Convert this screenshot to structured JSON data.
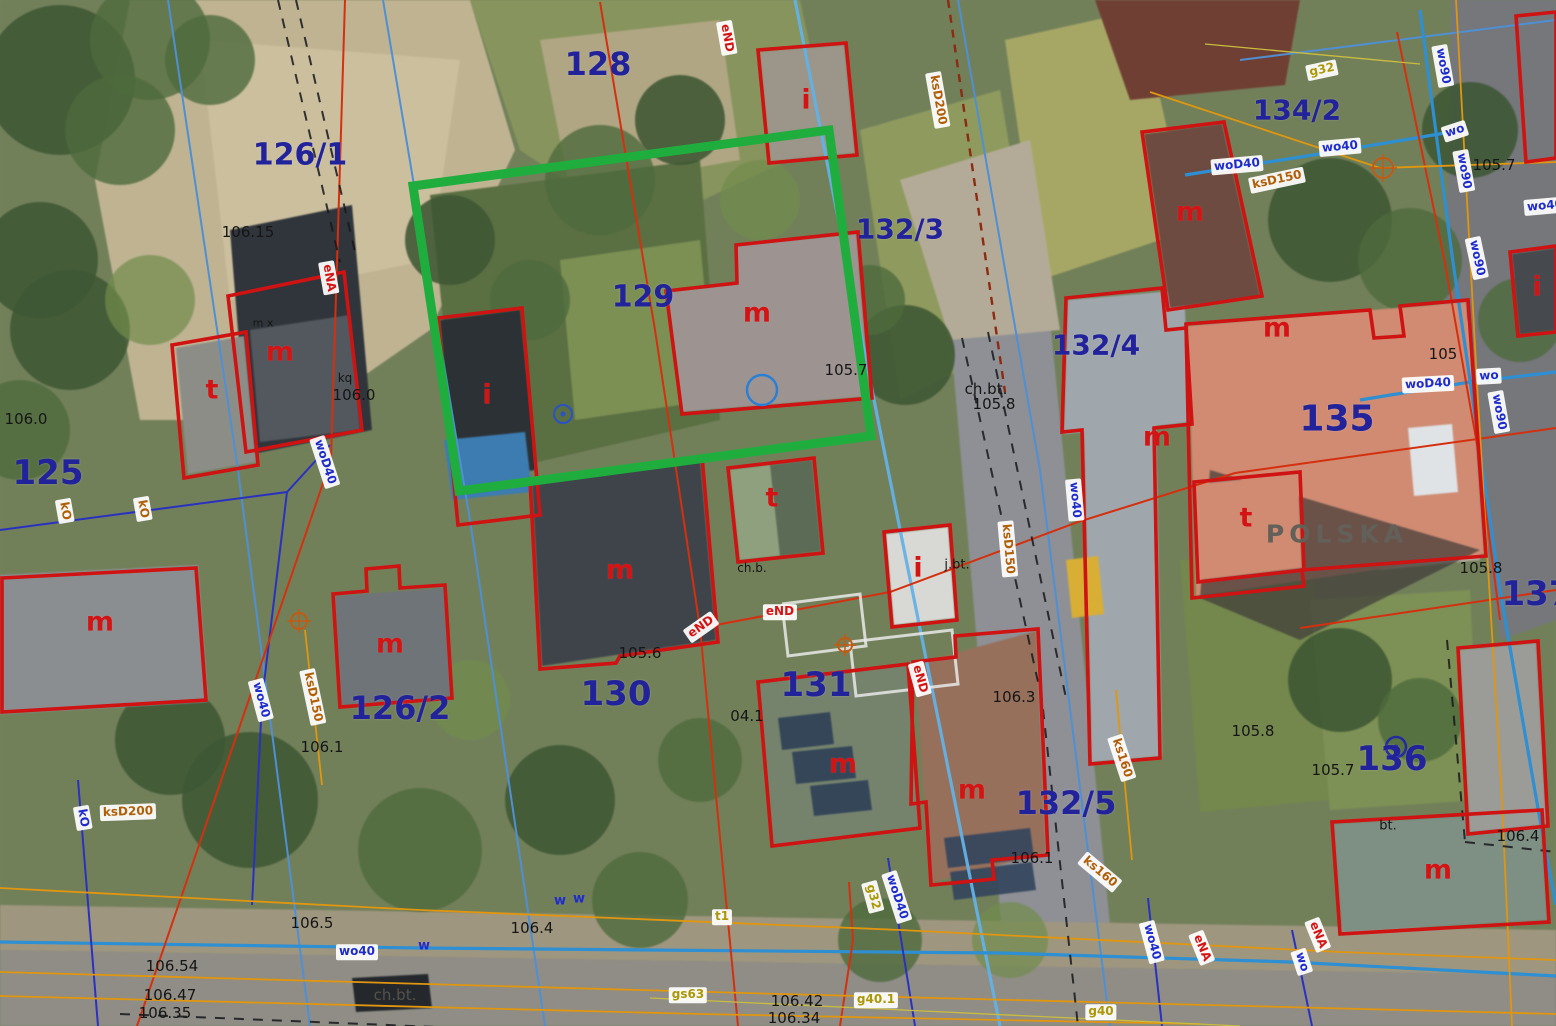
{
  "map": {
    "width": 1556,
    "height": 1026,
    "street_name": "POLSKA",
    "highlight": {
      "points": "413,186 829,130 871,436 459,491",
      "color": "#1fae3e",
      "stroke_width": 9
    },
    "colors": {
      "parcel_number": "#22229b",
      "building_letter": "#d41414",
      "water_label": "#1f2ccc",
      "sewer_label": "#b05e08",
      "gas_label": "#ab9708",
      "power_label": "#d41414",
      "highlight": "#1fae3e"
    },
    "parcel_labels": [
      {
        "text": "126/1",
        "x": 300,
        "y": 155,
        "s": 30
      },
      {
        "text": "128",
        "x": 598,
        "y": 64,
        "s": 32
      },
      {
        "text": "129",
        "x": 643,
        "y": 297,
        "s": 30
      },
      {
        "text": "132/3",
        "x": 900,
        "y": 229,
        "s": 28
      },
      {
        "text": "134/2",
        "x": 1297,
        "y": 110,
        "s": 28
      },
      {
        "text": "132/4",
        "x": 1096,
        "y": 345,
        "s": 28
      },
      {
        "text": "135",
        "x": 1337,
        "y": 419,
        "s": 36
      },
      {
        "text": "125",
        "x": 48,
        "y": 473,
        "s": 34
      },
      {
        "text": "126/2",
        "x": 400,
        "y": 708,
        "s": 32
      },
      {
        "text": "130",
        "x": 616,
        "y": 694,
        "s": 34
      },
      {
        "text": "131",
        "x": 816,
        "y": 685,
        "s": 34
      },
      {
        "text": "132/5",
        "x": 1066,
        "y": 803,
        "s": 32
      },
      {
        "text": "136",
        "x": 1392,
        "y": 759,
        "s": 34
      },
      {
        "text": "137",
        "x": 1537,
        "y": 594,
        "s": 34
      }
    ],
    "building_letters": [
      {
        "t": "t",
        "x": 212,
        "y": 390
      },
      {
        "t": "m",
        "x": 280,
        "y": 352
      },
      {
        "t": "m",
        "x": 100,
        "y": 622
      },
      {
        "t": "m",
        "x": 390,
        "y": 644
      },
      {
        "t": "i",
        "x": 487,
        "y": 395
      },
      {
        "t": "m",
        "x": 757,
        "y": 313
      },
      {
        "t": "i",
        "x": 806,
        "y": 100
      },
      {
        "t": "m",
        "x": 620,
        "y": 570
      },
      {
        "t": "t",
        "x": 772,
        "y": 498
      },
      {
        "t": "i",
        "x": 918,
        "y": 568
      },
      {
        "t": "m",
        "x": 1157,
        "y": 437
      },
      {
        "t": "m",
        "x": 1190,
        "y": 212
      },
      {
        "t": "m",
        "x": 1277,
        "y": 328
      },
      {
        "t": "t",
        "x": 1246,
        "y": 518
      },
      {
        "t": "m",
        "x": 1438,
        "y": 870
      },
      {
        "t": "i",
        "x": 1537,
        "y": 287
      },
      {
        "t": "m",
        "x": 843,
        "y": 764
      },
      {
        "t": "m",
        "x": 972,
        "y": 790
      }
    ],
    "surface_labels": [
      {
        "t": "106.15",
        "x": 248,
        "y": 232
      },
      {
        "t": "106.0",
        "x": 26,
        "y": 419
      },
      {
        "t": "kq",
        "x": 345,
        "y": 378,
        "s": 12
      },
      {
        "t": "106.0",
        "x": 354,
        "y": 395
      },
      {
        "t": "m x",
        "x": 263,
        "y": 323,
        "s": 11
      },
      {
        "t": "105.7",
        "x": 846,
        "y": 370
      },
      {
        "t": "ch.bt.",
        "x": 986,
        "y": 389
      },
      {
        "t": "105.8",
        "x": 994,
        "y": 404
      },
      {
        "t": "105.6",
        "x": 640,
        "y": 653
      },
      {
        "t": "04.1",
        "x": 747,
        "y": 716
      },
      {
        "t": "106.3",
        "x": 1014,
        "y": 697
      },
      {
        "t": "106.1",
        "x": 1032,
        "y": 858
      },
      {
        "t": "106.1",
        "x": 322,
        "y": 747
      },
      {
        "t": "105.8",
        "x": 1253,
        "y": 731
      },
      {
        "t": "105.7",
        "x": 1333,
        "y": 770
      },
      {
        "t": "105.7",
        "x": 1494,
        "y": 165
      },
      {
        "t": "105",
        "x": 1443,
        "y": 354
      },
      {
        "t": "105.8",
        "x": 1481,
        "y": 568
      },
      {
        "t": "106.4",
        "x": 1518,
        "y": 836
      },
      {
        "t": "106.54",
        "x": 172,
        "y": 966
      },
      {
        "t": "106.47",
        "x": 170,
        "y": 995
      },
      {
        "t": "106.35",
        "x": 165,
        "y": 1013
      },
      {
        "t": "106.4",
        "x": 532,
        "y": 928
      },
      {
        "t": "106.42",
        "x": 797,
        "y": 1001
      },
      {
        "t": "106.34",
        "x": 794,
        "y": 1018
      },
      {
        "t": "106.5",
        "x": 312,
        "y": 923
      },
      {
        "t": "ch.bt.",
        "x": 395,
        "y": 995,
        "c": "#55524b"
      },
      {
        "t": "ch.b.",
        "x": 752,
        "y": 568,
        "s": 12
      },
      {
        "t": "j.bt.",
        "x": 957,
        "y": 565,
        "s": 13
      },
      {
        "t": "bt.",
        "x": 1388,
        "y": 826,
        "s": 13
      },
      {
        "t": "POLSKA",
        "x": 1337,
        "y": 534,
        "s": 25,
        "c": "#63605a",
        "sp": 5,
        "b": true
      }
    ],
    "utility_labels": [
      {
        "t": "wo40",
        "x": 357,
        "y": 952,
        "r": 0,
        "type": "water"
      },
      {
        "t": "wo40",
        "x": 1340,
        "y": 147,
        "r": -5,
        "type": "water"
      },
      {
        "t": "woD40",
        "x": 1237,
        "y": 165,
        "r": -5,
        "type": "water"
      },
      {
        "t": "wo",
        "x": 1455,
        "y": 131,
        "r": -18,
        "type": "water"
      },
      {
        "t": "wo90",
        "x": 1443,
        "y": 66,
        "r": 80,
        "type": "water"
      },
      {
        "t": "wo90",
        "x": 1464,
        "y": 171,
        "r": 80,
        "type": "water"
      },
      {
        "t": "wo90",
        "x": 1477,
        "y": 258,
        "r": 78,
        "type": "water"
      },
      {
        "t": "wo40",
        "x": 1545,
        "y": 206,
        "r": -5,
        "type": "water"
      },
      {
        "t": "woD40",
        "x": 1428,
        "y": 384,
        "r": -3,
        "type": "water"
      },
      {
        "t": "wo",
        "x": 1489,
        "y": 376,
        "r": -3,
        "type": "water"
      },
      {
        "t": "wo90",
        "x": 1499,
        "y": 412,
        "r": 80,
        "type": "water"
      },
      {
        "t": "woD40",
        "x": 325,
        "y": 462,
        "r": 72,
        "type": "water"
      },
      {
        "t": "wo40",
        "x": 261,
        "y": 700,
        "r": 75,
        "type": "water"
      },
      {
        "t": "wo40",
        "x": 1075,
        "y": 500,
        "r": 85,
        "type": "water"
      },
      {
        "t": "kO",
        "x": 83,
        "y": 818,
        "r": 80,
        "type": "water"
      },
      {
        "t": "woD40",
        "x": 897,
        "y": 897,
        "r": 72,
        "type": "water"
      },
      {
        "t": "wo40",
        "x": 1152,
        "y": 942,
        "r": 75,
        "type": "water"
      },
      {
        "t": "wo",
        "x": 1302,
        "y": 962,
        "r": 72,
        "type": "water"
      },
      {
        "t": "w",
        "x": 560,
        "y": 902,
        "r": 0,
        "type": "water",
        "p": 1
      },
      {
        "t": "w",
        "x": 579,
        "y": 900,
        "r": 0,
        "type": "water",
        "p": 1
      },
      {
        "t": "w",
        "x": 424,
        "y": 947,
        "r": 0,
        "type": "water",
        "p": 1
      },
      {
        "t": "ksD200",
        "x": 938,
        "y": 100,
        "r": 80,
        "type": "sewer"
      },
      {
        "t": "ksD200",
        "x": 128,
        "y": 812,
        "r": -2,
        "type": "sewer"
      },
      {
        "t": "ksD150",
        "x": 1277,
        "y": 180,
        "r": -12,
        "type": "sewer"
      },
      {
        "t": "ksD150",
        "x": 1008,
        "y": 549,
        "r": 85,
        "type": "sewer"
      },
      {
        "t": "ksD150",
        "x": 313,
        "y": 697,
        "r": 78,
        "type": "sewer"
      },
      {
        "t": "ks160",
        "x": 1122,
        "y": 758,
        "r": 72,
        "type": "sewer"
      },
      {
        "t": "ks160",
        "x": 1100,
        "y": 872,
        "r": 40,
        "type": "sewer"
      },
      {
        "t": "kO",
        "x": 65,
        "y": 511,
        "r": 80,
        "type": "sewer"
      },
      {
        "t": "kO",
        "x": 143,
        "y": 509,
        "r": 80,
        "type": "sewer"
      },
      {
        "t": "g32",
        "x": 1322,
        "y": 70,
        "r": -12,
        "type": "gas"
      },
      {
        "t": "g32",
        "x": 873,
        "y": 897,
        "r": 75,
        "type": "gas"
      },
      {
        "t": "g40",
        "x": 1101,
        "y": 1012,
        "r": 0,
        "type": "gas"
      },
      {
        "t": "gs63",
        "x": 688,
        "y": 995,
        "r": 0,
        "type": "gas"
      },
      {
        "t": "g40.1",
        "x": 876,
        "y": 1000,
        "r": 0,
        "type": "gas"
      },
      {
        "t": "t1",
        "x": 722,
        "y": 917,
        "r": 0,
        "type": "gas"
      },
      {
        "t": "eND",
        "x": 727,
        "y": 38,
        "r": 80,
        "type": "power"
      },
      {
        "t": "eNA",
        "x": 329,
        "y": 278,
        "r": 80,
        "type": "power"
      },
      {
        "t": "eND",
        "x": 780,
        "y": 612,
        "r": 0,
        "type": "power"
      },
      {
        "t": "eND",
        "x": 701,
        "y": 627,
        "r": -35,
        "type": "power"
      },
      {
        "t": "eND",
        "x": 920,
        "y": 679,
        "r": 75,
        "type": "power"
      },
      {
        "t": "eNA",
        "x": 1202,
        "y": 948,
        "r": 68,
        "type": "power"
      },
      {
        "t": "eNA",
        "x": 1318,
        "y": 935,
        "r": 68,
        "type": "power"
      }
    ],
    "symbols": [
      {
        "k": "ring",
        "x": 762,
        "y": 390,
        "rad": 15,
        "c": "#2a7fd4",
        "w": 2.5
      },
      {
        "k": "dotring",
        "x": 563,
        "y": 414,
        "rad": 9,
        "c": "#2a52c8",
        "w": 2
      },
      {
        "k": "dotring",
        "x": 1396,
        "y": 747,
        "rad": 10,
        "c": "#232b9e",
        "w": 2.5
      },
      {
        "k": "target",
        "x": 1383,
        "y": 168,
        "rad": 10,
        "c": "#c25a12",
        "w": 2
      },
      {
        "k": "target",
        "x": 299,
        "y": 621,
        "rad": 8,
        "c": "#c25a12",
        "w": 2
      },
      {
        "k": "target",
        "x": 845,
        "y": 645,
        "rad": 7,
        "c": "#c25a12",
        "w": 2
      }
    ],
    "overlay": {
      "lines": [
        {
          "cls": "parcel-line",
          "pts": "168,0 238,470 310,1026"
        },
        {
          "cls": "parcel-line",
          "pts": "383,0 470,520 545,1026"
        },
        {
          "cls": "parcel-line",
          "pts": "958,0 1040,470 1110,1026"
        },
        {
          "cls": "parcel-line",
          "pts": "1240,60 1556,20"
        },
        {
          "cls": "parcelLight",
          "pts": "795,0 880,430 1000,1026"
        },
        {
          "cls": "water",
          "pts": "0,942 420,948 1000,953 1290,962 1556,976"
        },
        {
          "cls": "water",
          "pts": "1185,175 1332,152 1445,133"
        },
        {
          "cls": "water",
          "pts": "1360,400 1470,382 1556,372"
        },
        {
          "cls": "water",
          "pts": "1420,10 1452,255 1500,590 1540,820 1556,905"
        },
        {
          "cls": "darkblue",
          "pts": "0,530 287,492 330,445"
        },
        {
          "cls": "darkblue",
          "pts": "287,492 262,700 252,905"
        },
        {
          "cls": "darkblue",
          "pts": "78,780 98,1026"
        },
        {
          "cls": "darkblue",
          "pts": "888,858 915,1026"
        },
        {
          "cls": "darkblue",
          "pts": "1148,898 1162,1026"
        },
        {
          "cls": "darkblue",
          "pts": "1292,930 1312,1026"
        },
        {
          "cls": "power",
          "pts": "345,0 331,460 137,1026"
        },
        {
          "cls": "power",
          "pts": "600,2 655,330 700,628 738,1026"
        },
        {
          "cls": "power",
          "pts": "700,628 890,592 1078,522 1235,473 1556,428"
        },
        {
          "cls": "power",
          "pts": "1397,32 1444,258 1478,450 1500,620"
        },
        {
          "cls": "power",
          "pts": "1300,628 1556,590"
        },
        {
          "cls": "power",
          "pts": "840,1026 853,940 849,882"
        },
        {
          "cls": "gas",
          "pts": "0,888 420,910 900,930 1340,952 1556,960"
        },
        {
          "cls": "gas",
          "pts": "0,972 780,994 1556,1014"
        },
        {
          "cls": "gas",
          "pts": "0,996 700,1014 1200,1024"
        },
        {
          "cls": "gas",
          "pts": "1456,0 1478,400 1502,800 1512,1026"
        },
        {
          "cls": "gas",
          "pts": "1150,92 1380,168 1556,162"
        },
        {
          "cls": "gas",
          "pts": "1116,690 1132,860"
        },
        {
          "cls": "gas",
          "pts": "305,630 322,785"
        },
        {
          "cls": "gasThin",
          "pts": "1205,44 1420,64"
        },
        {
          "cls": "gasThin",
          "pts": "650,998 1240,1026"
        },
        {
          "cls": "sewerDash",
          "pts": "948,0 1005,392"
        },
        {
          "cls": "roadDash",
          "pts": "962,338 1042,700 1078,1026"
        },
        {
          "cls": "roadDash",
          "pts": "988,332 1066,698"
        },
        {
          "cls": "roadDash",
          "pts": "120,1014 850,1044"
        },
        {
          "cls": "roadDash",
          "pts": "278,0 340,262"
        },
        {
          "cls": "roadDash",
          "pts": "296,0 356,256"
        },
        {
          "cls": "roadDash",
          "pts": "1447,640 1465,842"
        },
        {
          "cls": "roadDash",
          "pts": "1465,842 1556,852"
        },
        {
          "cls": "whiteMark",
          "pts": "782,604 860,594 866,646 788,656 782,604"
        },
        {
          "cls": "whiteMark",
          "pts": "850,642 952,630 958,684 856,696 850,642"
        }
      ],
      "red_buildings": [
        "172,345 246,332 258,465 184,478",
        "228,296 344,272 362,430 246,452",
        "2,578 196,568 206,700 2,712",
        "333,594 367,591 366,569 399,566 400,588 445,585 452,698 340,707",
        "438,318 522,308 540,515 458,525",
        "666,291 737,283 736,245 858,232 872,398 682,414",
        "758,50 846,43 857,155 769,163",
        "530,480 702,456 718,642 620,656 616,663 540,669",
        "728,468 814,458 823,553 738,562",
        "884,532 950,525 957,620 892,627",
        "1066,298 1162,288 1166,330 1186,328 1192,424 1154,428 1160,758 1090,764 1082,430 1062,432",
        "1142,132 1224,122 1262,296 1168,310",
        "1186,324 1370,310 1374,338 1404,336 1400,306 1468,300 1486,556 1302,570 1304,586 1192,598",
        "1194,482 1300,472 1304,570 1198,582",
        "1332,822 1542,810 1549,922 1340,934",
        "1458,648 1538,641 1548,826 1468,834",
        "1516,16 1556,12 1556,158 1526,162",
        "1510,252 1556,246 1556,332 1518,336",
        "758,682 908,664 920,828 772,846",
        "913,662 956,657 955,636 1038,629 1048,855 992,860 994,879 931,885 926,802 911,804"
      ]
    }
  }
}
